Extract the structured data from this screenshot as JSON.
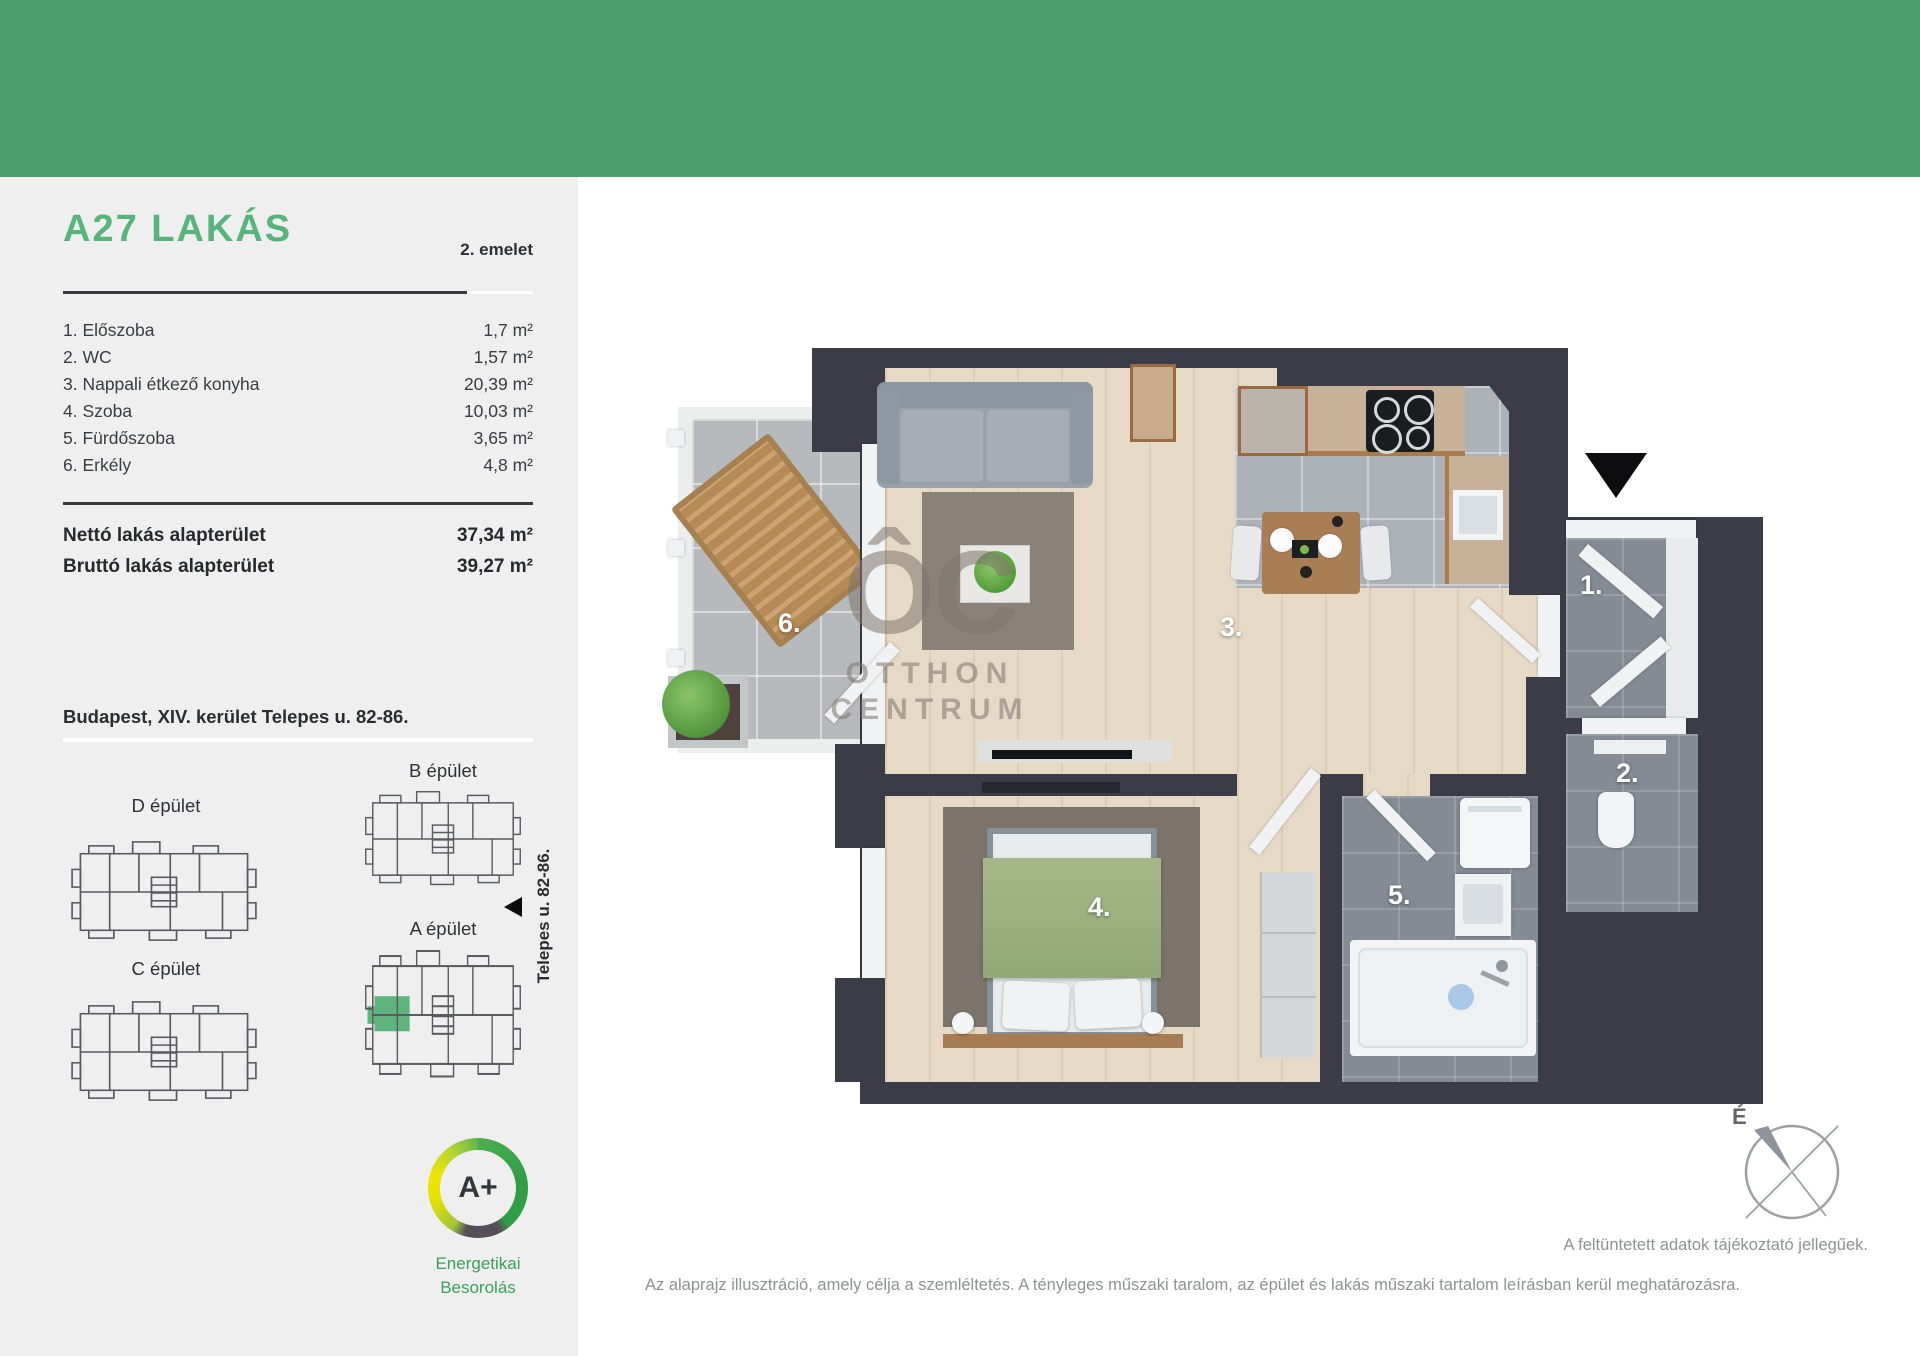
{
  "sidebar": {
    "title": "A27 LAKÁS",
    "floor_label": "2. emelet",
    "rooms": [
      {
        "label": "1. Előszoba",
        "area": "1,7 m²"
      },
      {
        "label": "2. WC",
        "area": "1,57 m²"
      },
      {
        "label": "3. Nappali étkező konyha",
        "area": "20,39 m²"
      },
      {
        "label": "4. Szoba",
        "area": "10,03 m²"
      },
      {
        "label": "5. Fürdőszoba",
        "area": "3,65 m²"
      },
      {
        "label": "6. Erkély",
        "area": "4,8 m²"
      }
    ],
    "totals": [
      {
        "label": "Nettó lakás alapterület",
        "value": "37,34 m²"
      },
      {
        "label": "Bruttó lakás alapterület",
        "value": "39,27 m²"
      }
    ],
    "address": "Budapest, XIV. kerület Telepes u. 82-86.",
    "buildings": {
      "d": "D épület",
      "b": "B épület",
      "c": "C épület",
      "a": "A épület"
    },
    "street_label": "Telepes u. 82-86.",
    "energy": {
      "rating": "A+",
      "line1": "Energetikai",
      "line2": "Besorolás"
    }
  },
  "floorplan": {
    "numbers": {
      "hall": "1.",
      "wc": "2.",
      "living": "3.",
      "bedroom": "4.",
      "bathroom": "5.",
      "balcony": "6."
    },
    "watermark": {
      "logo": "ÔC",
      "line1": "OTTHON",
      "line2": "CENTRUM"
    },
    "compass": "É"
  },
  "footer": {
    "note_right": "A feltüntetett adatok tájékoztató jellegűek.",
    "note_main": "Az alaprajz illusztráció, amely célja a szemléltetés. A tényleges műszaki taralom, az épület és lakás műszaki tartalom leírásban kerül meghatározásra."
  },
  "colors": {
    "brand_green": "#4d9e6d",
    "title_green": "#57b57c",
    "highlight_green": "#5fb47d"
  }
}
